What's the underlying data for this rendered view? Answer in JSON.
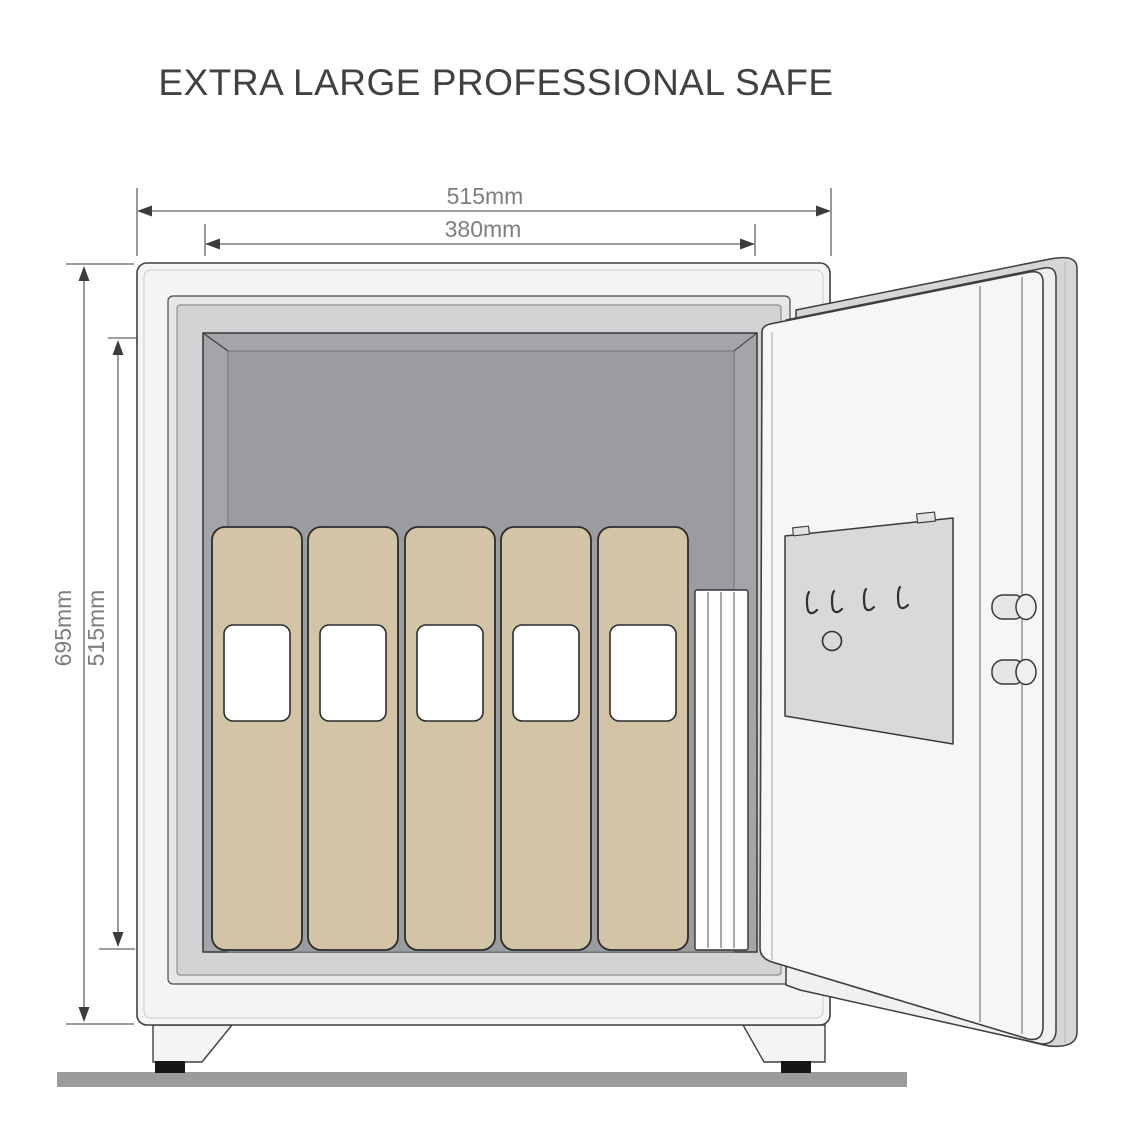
{
  "title": "EXTRA LARGE PROFESSIONAL SAFE",
  "dimensions": {
    "outer_width_label": "515mm",
    "inner_width_label": "380mm",
    "outer_height_label": "695mm",
    "inner_height_label": "515mm"
  },
  "safe": {
    "binder_count": 5,
    "document_stack_sheets": 4,
    "key_hook_count": 4,
    "lock_bolt_count": 2,
    "hinge_pin_count": 2,
    "foot_count": 2,
    "door_state": "open"
  },
  "colors": {
    "safe_body": "#f4f4f3",
    "frame_band": "#e7e7e6",
    "frame_lip": "#d3d3d5",
    "interior_wall": "#a4a5a8",
    "interior_back": "#9b9ca0",
    "binder": "#d3c4a5",
    "binder_label": "#ffffff",
    "paper": "#fdfdfd",
    "door_face": "#f6f6f5",
    "door_mid": "#f0f0ef",
    "door_edge": "#d6d6d7",
    "key_panel": "#d8d9da",
    "ground": "#9b9b9b",
    "foot_pad": "#151515",
    "outline": "#3c3c3e",
    "dimension_line": "#626366",
    "dimension_text": "#7d7e81",
    "title_text": "#414143"
  }
}
